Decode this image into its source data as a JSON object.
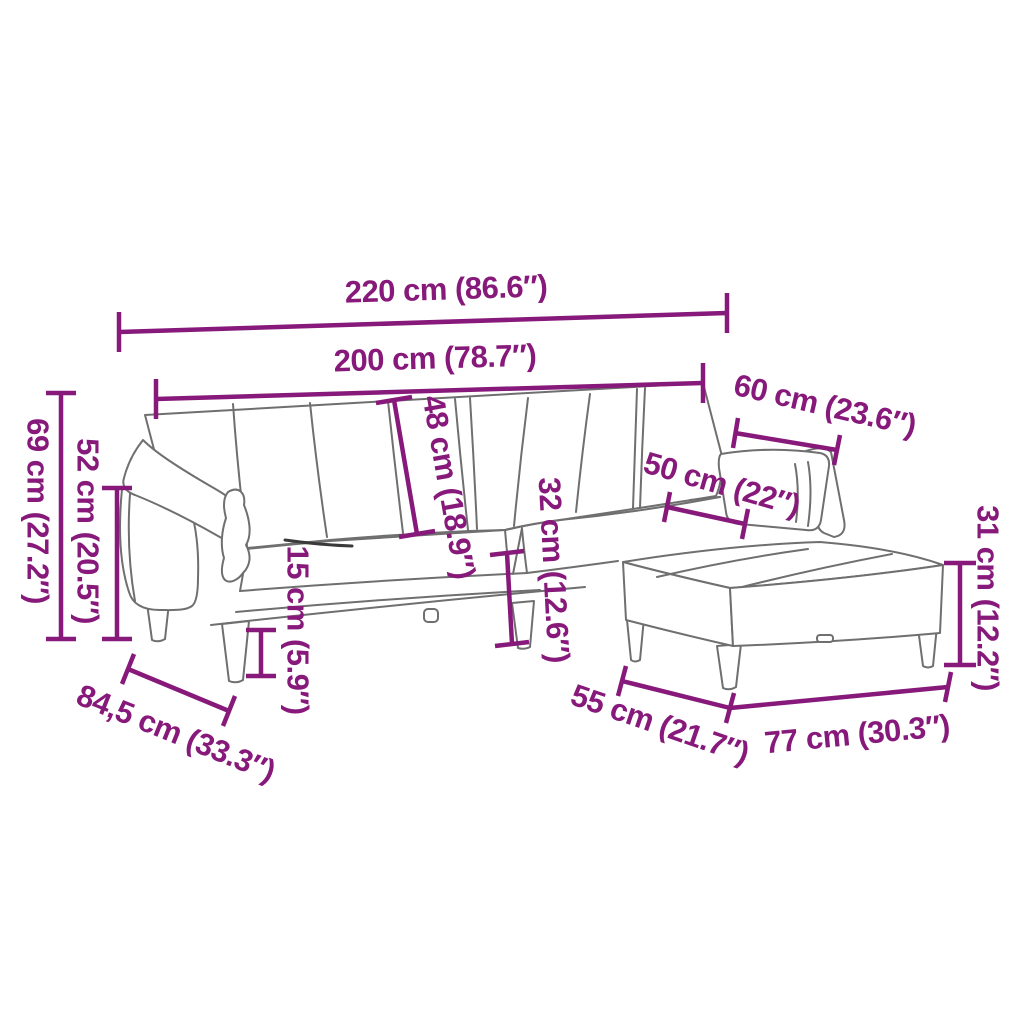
{
  "canvas": {
    "width": 1024,
    "height": 1024,
    "background": "#ffffff"
  },
  "style": {
    "dimension_color": "#87197B",
    "outline_color": "#6f6f6f",
    "shadow_line_color": "#3a3a3a"
  },
  "dimensions": [
    {
      "id": "width-total",
      "label": "220 cm (86.6″)",
      "cm": "220",
      "inch": "86.6"
    },
    {
      "id": "width-seat",
      "label": "200 cm (78.7″)",
      "cm": "200",
      "inch": "78.7"
    },
    {
      "id": "height-total",
      "label": "69 cm (27.2″)",
      "cm": "69",
      "inch": "27.2"
    },
    {
      "id": "height-armrest",
      "label": "52 cm (20.5″)",
      "cm": "52",
      "inch": "20.5"
    },
    {
      "id": "height-backrest",
      "label": "48 cm (18.9″)",
      "cm": "48",
      "inch": "18.9"
    },
    {
      "id": "height-leg",
      "label": "15 cm (5.9″)",
      "cm": "15",
      "inch": "5.9"
    },
    {
      "id": "height-seat",
      "label": "32 cm (12.6″)",
      "cm": "32",
      "inch": "12.6"
    },
    {
      "id": "pillow-width",
      "label": "50 cm (22″)",
      "cm": "50",
      "inch": "22"
    },
    {
      "id": "pillow-length",
      "label": "60 cm (23.6″)",
      "cm": "60",
      "inch": "23.6"
    },
    {
      "id": "footstool-height",
      "label": "31 cm (12.2″)",
      "cm": "31",
      "inch": "12.2"
    },
    {
      "id": "depth-sofa",
      "label": "84,5 cm (33.3″)",
      "cm": "84,5",
      "inch": "33.3"
    },
    {
      "id": "footstool-depth",
      "label": "55 cm (21.7″)",
      "cm": "55",
      "inch": "21.7"
    },
    {
      "id": "footstool-width",
      "label": "77 cm (30.3″)",
      "cm": "77",
      "inch": "30.3"
    }
  ]
}
